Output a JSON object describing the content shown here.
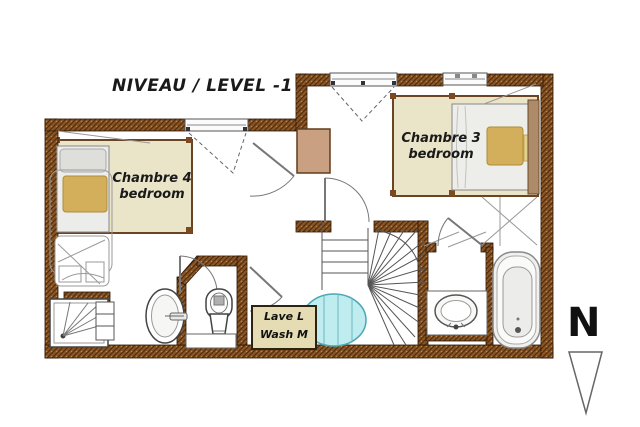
{
  "title": "NIVEAU / LEVEL -1",
  "rooms": [
    {
      "name_fr": "Chambre 4",
      "name_en": "bedroom"
    },
    {
      "name_fr": "Chambre 3",
      "name_en": "bedroom"
    }
  ],
  "laundry": {
    "line1": "Lave L",
    "line2": "Wash M"
  },
  "compass": {
    "letter": "N",
    "direction": "north-pointing-down-triangle"
  },
  "fixtures": {
    "chambre4": "double-bed",
    "chambre3": "double-bed",
    "bottom_left": [
      "shower-tray",
      "storage-cabinet",
      "washbasin",
      "toilet"
    ],
    "bottom_right": [
      "washbasin-counter",
      "bathtub"
    ],
    "center": [
      "winder-staircase",
      "stair-opening",
      "washing-machine",
      "chimney-flue"
    ]
  },
  "colors": {
    "wall_brown": "#8a5526",
    "wall_dark": "#4f2d0d",
    "wall_light": "#c08440",
    "room_beige": "#eae4c8",
    "chimney_tan": "#c9a081",
    "stair_opening_cyan": "#bfecef",
    "pillow_gold": "#d3af5b",
    "laundry_box_bg": "#e6dcb4"
  }
}
